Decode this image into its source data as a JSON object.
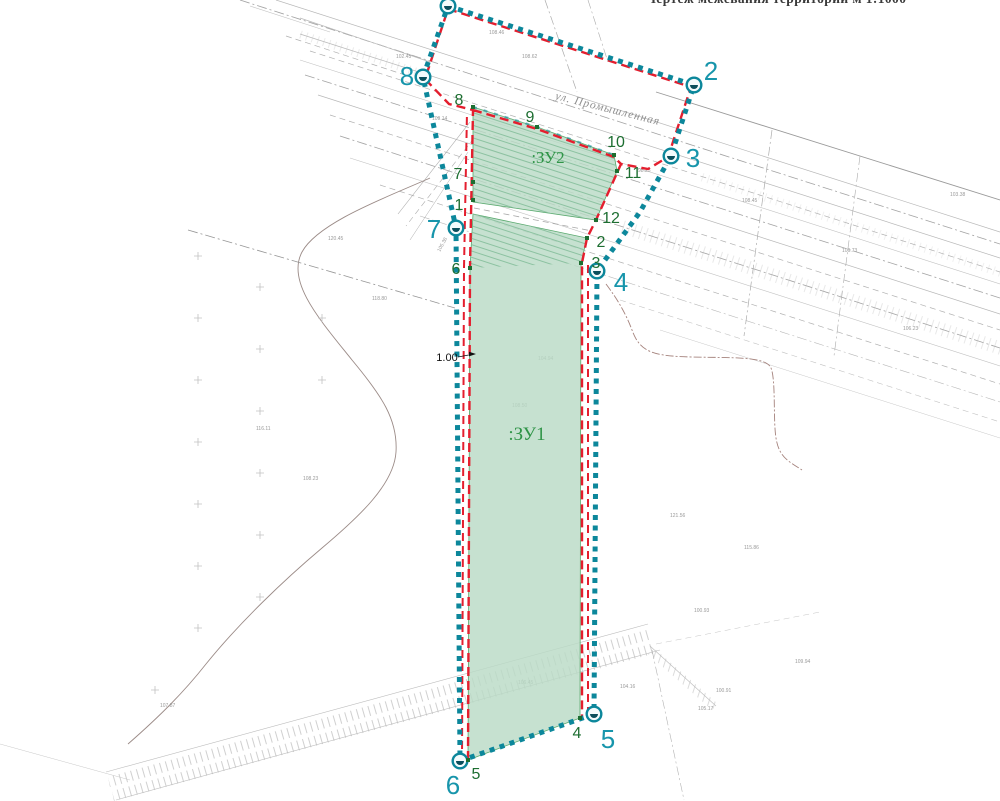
{
  "title": "Чертеж межевания территории м 1:1000",
  "map": {
    "street_label": "ул. Промышленная",
    "dimension_label": "1.00",
    "parcel_labels": {
      "zu1": ":ЗУ1",
      "zu2": ":ЗУ2"
    },
    "colors": {
      "boundary_teal": "#0c879b",
      "teal_number": "#1795ab",
      "boundary_red": "#e41e2e",
      "parcel_fill": "#b9dbc6",
      "parcel_hatch": "#86bf9c",
      "vertex_green": "#1d6e31",
      "parcel_label_green": "#2f9447",
      "linework_gray": "#b0b0b0"
    },
    "survey_points": [
      {
        "label": "",
        "cx": 448,
        "cy": 6,
        "lx": 430,
        "ly": 0
      },
      {
        "label": "2",
        "cx": 694,
        "cy": 85,
        "lx": 711,
        "ly": 80
      },
      {
        "label": "3",
        "cx": 671,
        "cy": 156,
        "lx": 693,
        "ly": 167
      },
      {
        "label": "4",
        "cx": 597,
        "cy": 271,
        "lx": 621,
        "ly": 291
      },
      {
        "label": "5",
        "cx": 594,
        "cy": 714,
        "lx": 608,
        "ly": 748
      },
      {
        "label": "6",
        "cx": 460,
        "cy": 761,
        "lx": 453,
        "ly": 794
      },
      {
        "label": "7",
        "cx": 456,
        "cy": 228,
        "lx": 434,
        "ly": 238
      },
      {
        "label": "8",
        "cx": 423,
        "cy": 77,
        "lx": 407,
        "ly": 85
      }
    ],
    "vertices": [
      {
        "label": "1",
        "x": 473,
        "y": 200,
        "lx": 459,
        "ly": 210
      },
      {
        "label": "2",
        "x": 587,
        "y": 238,
        "lx": 601,
        "ly": 247
      },
      {
        "label": "3",
        "x": 581,
        "y": 263,
        "lx": 596,
        "ly": 268
      },
      {
        "label": "4",
        "x": 580,
        "y": 718,
        "lx": 577,
        "ly": 738
      },
      {
        "label": "5",
        "x": 468,
        "y": 760,
        "lx": 476,
        "ly": 779
      },
      {
        "label": "6",
        "x": 470,
        "y": 268,
        "lx": 456,
        "ly": 274
      },
      {
        "label": "7",
        "x": 473,
        "y": 182,
        "lx": 458,
        "ly": 179
      },
      {
        "label": "8",
        "x": 473,
        "y": 107,
        "lx": 459,
        "ly": 105
      },
      {
        "label": "9",
        "x": 537,
        "y": 127,
        "lx": 530,
        "ly": 122
      },
      {
        "label": "10",
        "x": 614,
        "y": 155,
        "lx": 616,
        "ly": 147
      },
      {
        "label": "11",
        "x": 617,
        "y": 171,
        "lx": 633,
        "ly": 178
      },
      {
        "label": "12",
        "x": 596,
        "y": 220,
        "lx": 611,
        "ly": 223
      }
    ],
    "micro_labels": [
      {
        "t": "108.46",
        "x": 489,
        "y": 34
      },
      {
        "t": "108.62",
        "x": 522,
        "y": 58
      },
      {
        "t": "102.45",
        "x": 396,
        "y": 58
      },
      {
        "t": "109.14",
        "x": 432,
        "y": 120
      },
      {
        "t": "98.25",
        "x": 638,
        "y": 172
      },
      {
        "t": "103.38",
        "x": 950,
        "y": 196
      },
      {
        "t": "108.45",
        "x": 742,
        "y": 202
      },
      {
        "t": "106.73",
        "x": 842,
        "y": 252
      },
      {
        "t": "106.23",
        "x": 903,
        "y": 330
      },
      {
        "t": "120.45",
        "x": 328,
        "y": 240
      },
      {
        "t": "118.80",
        "x": 372,
        "y": 300
      },
      {
        "t": "105.38",
        "x": 440,
        "y": 252,
        "r": -62
      },
      {
        "t": "116.11",
        "x": 256,
        "y": 430
      },
      {
        "t": "108.23",
        "x": 303,
        "y": 480
      },
      {
        "t": "108.50",
        "x": 512,
        "y": 407
      },
      {
        "t": "104.94",
        "x": 538,
        "y": 360
      },
      {
        "t": "107.87",
        "x": 160,
        "y": 707
      },
      {
        "t": "106.45",
        "x": 518,
        "y": 684
      },
      {
        "t": "104.16",
        "x": 620,
        "y": 688
      },
      {
        "t": "121.56",
        "x": 670,
        "y": 517
      },
      {
        "t": "115.86",
        "x": 744,
        "y": 549
      },
      {
        "t": "100.93",
        "x": 694,
        "y": 612
      },
      {
        "t": "109.94",
        "x": 795,
        "y": 663
      },
      {
        "t": "100.91",
        "x": 716,
        "y": 692
      },
      {
        "t": "105.17",
        "x": 698,
        "y": 710
      }
    ],
    "grid_crosses": [
      [
        198,
        256
      ],
      [
        198,
        318
      ],
      [
        198,
        380
      ],
      [
        198,
        442
      ],
      [
        198,
        504
      ],
      [
        198,
        566
      ],
      [
        198,
        628
      ],
      [
        260,
        287
      ],
      [
        260,
        349
      ],
      [
        260,
        411
      ],
      [
        260,
        473
      ],
      [
        260,
        535
      ],
      [
        260,
        597
      ],
      [
        322,
        318
      ],
      [
        322,
        380
      ],
      [
        155,
        690
      ]
    ]
  }
}
